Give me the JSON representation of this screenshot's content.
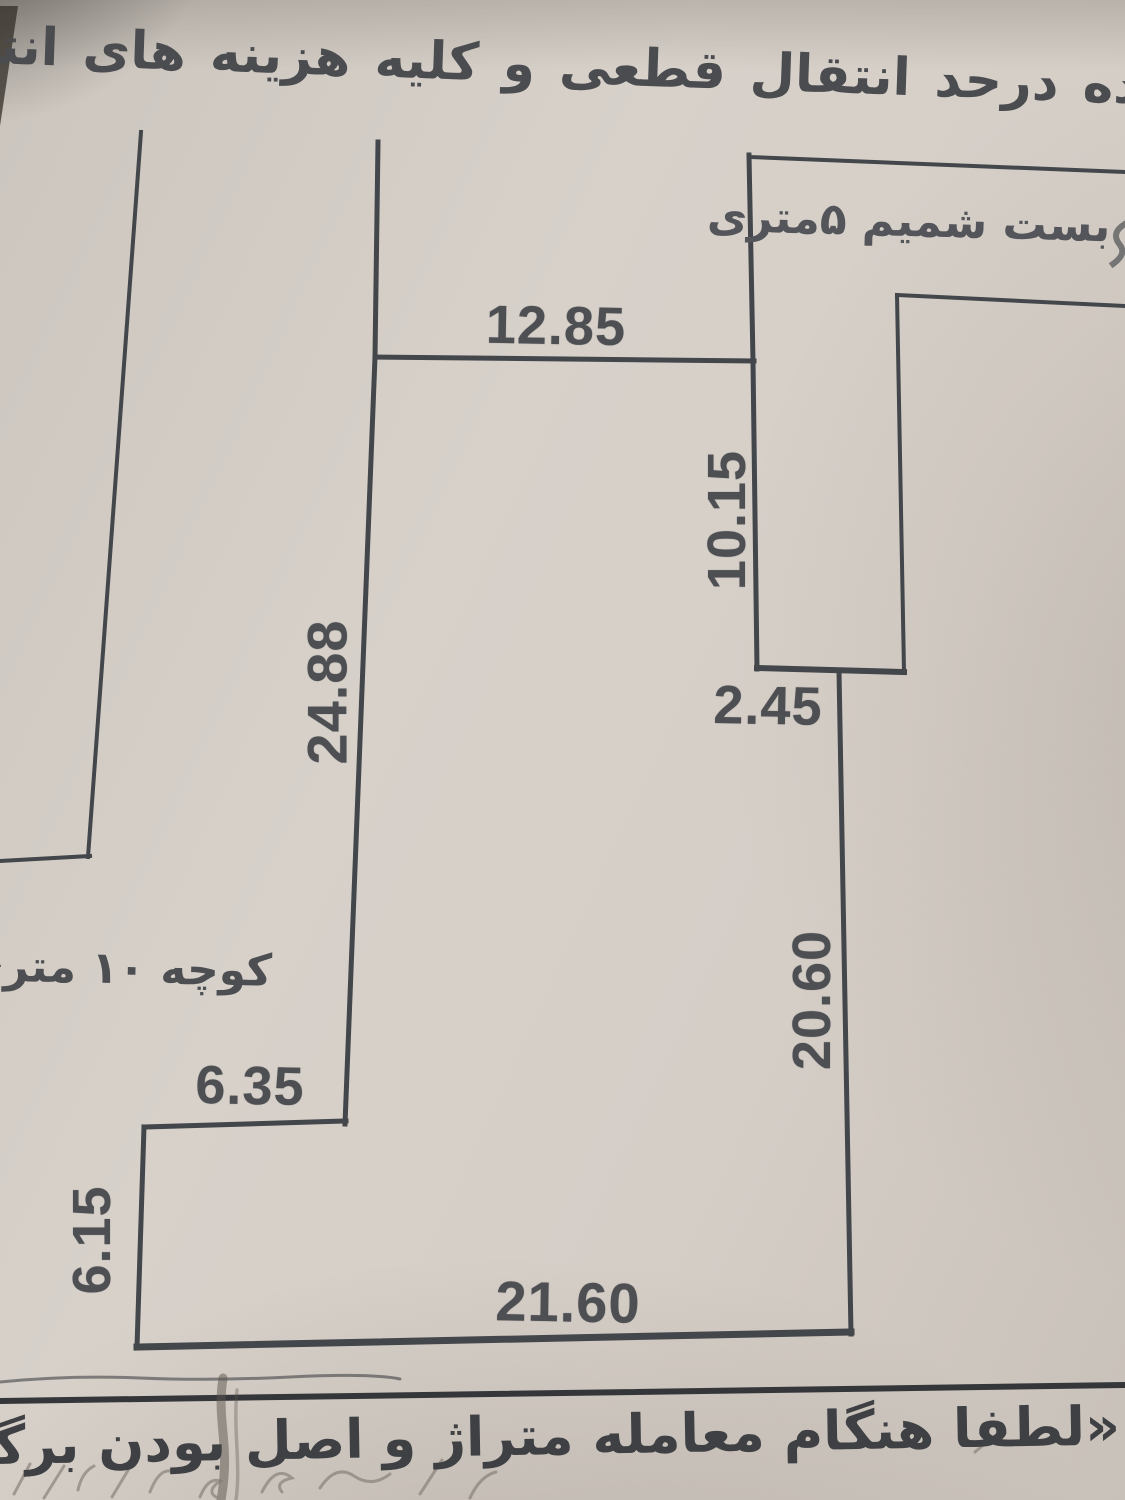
{
  "paper": {
    "bg": "#d5cfc8",
    "line_color": "#43464a",
    "text_color": "#46484c"
  },
  "top_note": "شده درحد انتقال قطعی و کلیه هزینه های انتقال بعهده",
  "plot": {
    "dimensions": {
      "top_edge": "12.85",
      "right_upper_edge": "10.15",
      "left_edge": "24.88",
      "right_step": "2.45",
      "right_lower_edge": "20.60",
      "bottom_edge": "21.60",
      "notch_width": "6.35",
      "notch_height": "6.15"
    },
    "streets": {
      "top_right_deadend": "بست شمیم ۵متری",
      "left_alley": "کوچه ۱۰ متری"
    }
  },
  "bottom_note": "«لطفا هنگام معامله متراژ و اصل بودن برگه کارشناسی"
}
